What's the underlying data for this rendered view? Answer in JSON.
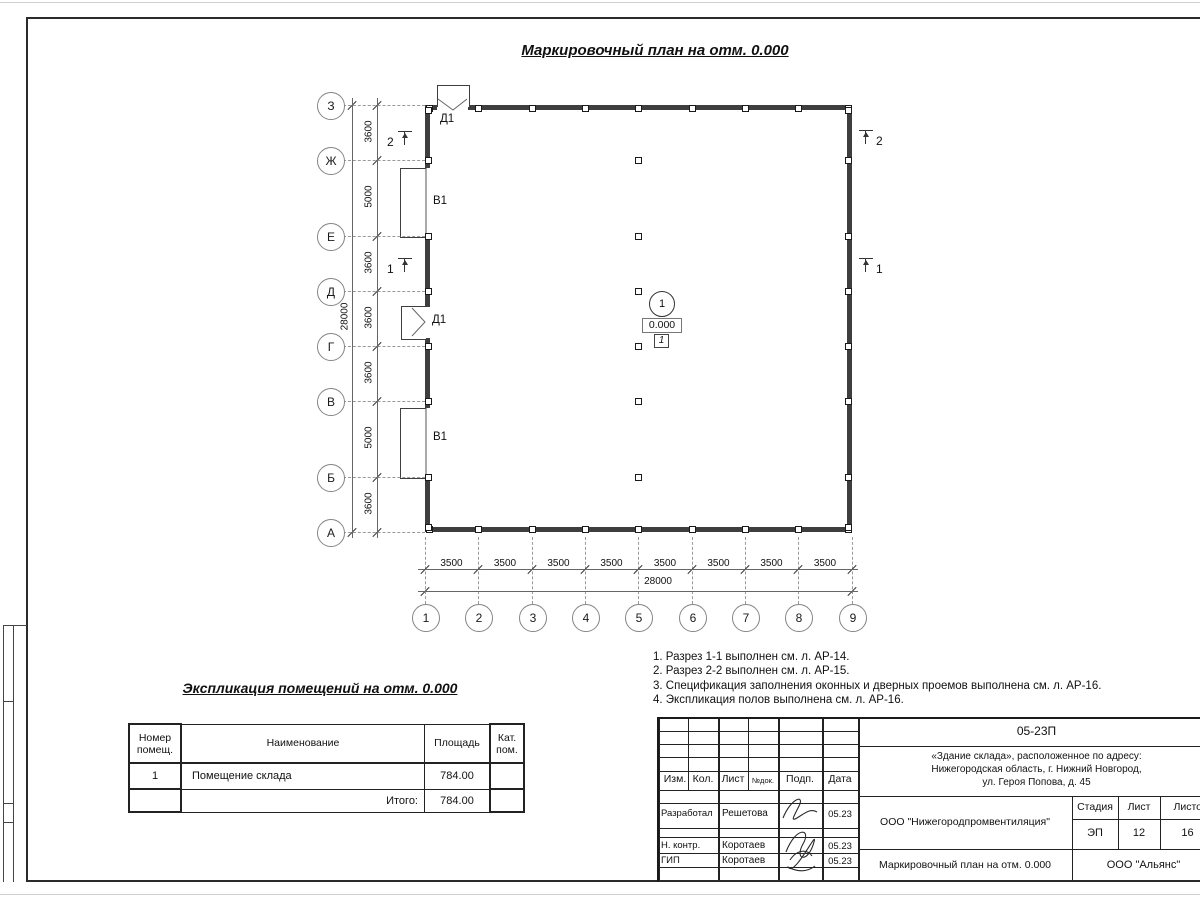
{
  "plan": {
    "title": "Маркировочный план на отм. 0.000",
    "axes_rows": [
      "З",
      "Ж",
      "Е",
      "Д",
      "Г",
      "В",
      "Б",
      "А"
    ],
    "row_dims": [
      "3600",
      "5000",
      "3600",
      "3600",
      "3600",
      "5000",
      "3600"
    ],
    "rows_total": "28000",
    "axes_cols": [
      "1",
      "2",
      "3",
      "4",
      "5",
      "6",
      "7",
      "8",
      "9"
    ],
    "col_dims": [
      "3500",
      "3500",
      "3500",
      "3500",
      "3500",
      "3500",
      "3500",
      "3500"
    ],
    "cols_total": "28000",
    "door_mark": "Д1",
    "window_mark": "В1",
    "room_number": "1",
    "elevation": "0.000",
    "floor_type": "1",
    "section_1": "1",
    "section_2": "2"
  },
  "notes": {
    "lines": [
      "1. Разрез 1-1 выполнен см. л. АР-14.",
      "2. Разрез 2-2 выполнен см. л. АР-15.",
      "3. Спецификация заполнения оконных и дверных проемов выполнена см. л. АР-16.",
      "4. Экспликация полов выполнена см. л. АР-16."
    ]
  },
  "explication": {
    "title": "Экспликация помещений на отм. 0.000",
    "headers": [
      "Номер помещ.",
      "Наименование",
      "Площадь",
      "Кат. пом."
    ],
    "row": {
      "number": "1",
      "name": "Помещение склада",
      "area": "784.00",
      "cat": ""
    },
    "total_label": "Итого:",
    "total_value": "784.00"
  },
  "titleblock": {
    "doc_number": "05-23П",
    "address_lines": [
      "«Здание склада», расположенное по адресу:",
      "Нижегородская область, г. Нижний Новгород,",
      "ул. Героя Попова, д. 45"
    ],
    "header_cols": [
      "Изм.",
      "Кол.",
      "Лист",
      "№док.",
      "Подп.",
      "Дата"
    ],
    "rows": [
      {
        "role": "Разработал",
        "name": "Решетова",
        "date": "05.23"
      },
      {
        "role": "Н. контр.",
        "name": "Коротаев",
        "date": "05.23"
      },
      {
        "role": "ГИП",
        "name": "Коротаев",
        "date": "05.23"
      }
    ],
    "company": "ООО \"Нижегородпромвентиляция\"",
    "sheet_title": "Маркировочный план на отм. 0.000",
    "firm": "ООО \"Альянс\"",
    "stage_label": "Стадия",
    "sheet_label": "Лист",
    "sheets_label": "Листов",
    "stage": "ЭП",
    "sheet_no": "12",
    "sheets_total": "16"
  }
}
